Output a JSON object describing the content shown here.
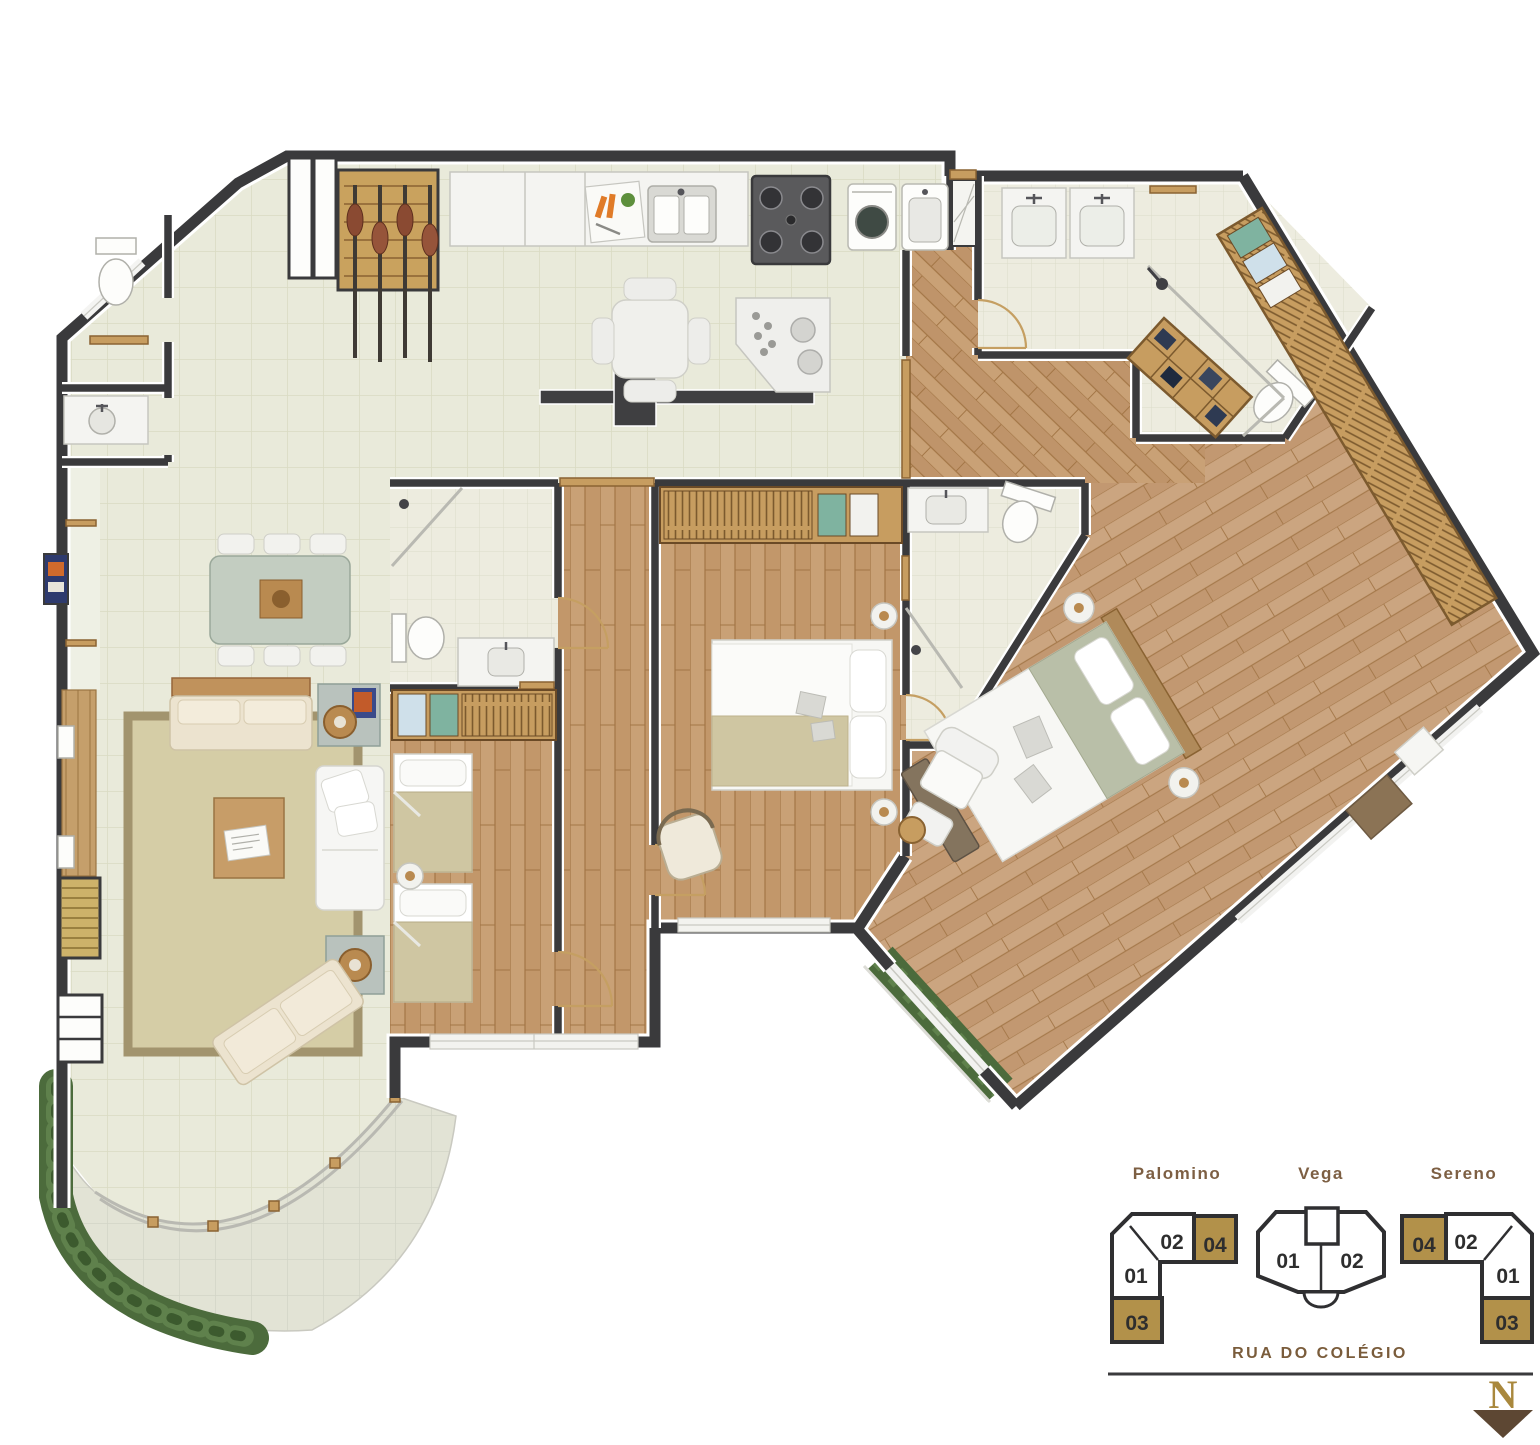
{
  "legend": {
    "buildings": [
      {
        "name": "Palomino",
        "units": [
          {
            "label": "01",
            "highlighted": false
          },
          {
            "label": "02",
            "highlighted": false
          },
          {
            "label": "03",
            "highlighted": true
          },
          {
            "label": "04",
            "highlighted": true
          }
        ]
      },
      {
        "name": "Vega",
        "units": [
          {
            "label": "01",
            "highlighted": false
          },
          {
            "label": "02",
            "highlighted": false
          }
        ]
      },
      {
        "name": "Sereno",
        "units": [
          {
            "label": "01",
            "highlighted": false
          },
          {
            "label": "02",
            "highlighted": false
          },
          {
            "label": "03",
            "highlighted": true
          },
          {
            "label": "04",
            "highlighted": true
          }
        ]
      }
    ],
    "street_label": "RUA DO COLÉGIO",
    "north_label": "N"
  },
  "colors": {
    "wall": "#3a3a3c",
    "tile_floor": "#e9eada",
    "bath_tile": "#edecdf",
    "terrace_floor": "#e2e3d5",
    "wood_floor": "#c9a176",
    "deck_wood": "#c59f6b",
    "rug": "#d5cda6",
    "rug_border": "#a2946e",
    "unit_highlight": "#b2914a",
    "legend_text": "#7d5f43",
    "unit_number_text": "#2e2e2e",
    "street_text": "#7a5c3b",
    "north_gold": "#a9883d",
    "north_brown": "#5d4733",
    "foliage": "#4c6b3c",
    "furniture_white": "#f5f5f3",
    "furniture_cream": "#ece3cf",
    "wardrobe_tan": "#c79d60"
  }
}
